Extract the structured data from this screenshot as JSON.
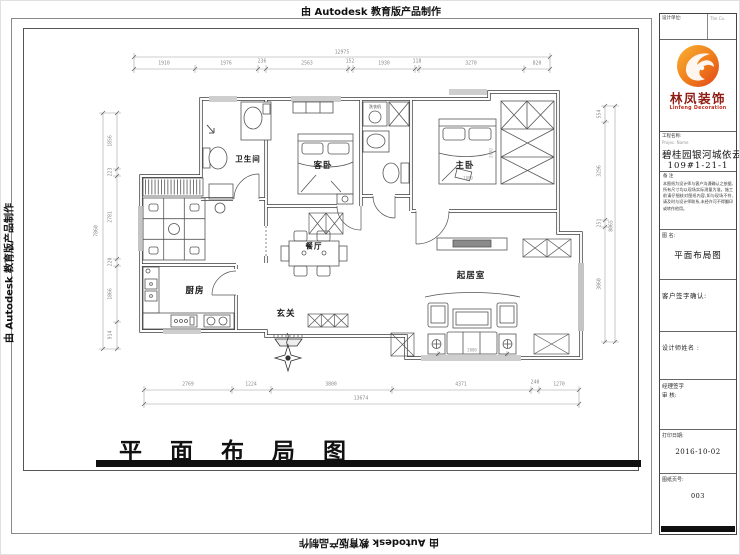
{
  "banner": {
    "autodesk": "由 Autodesk 教育版产品制作"
  },
  "drawing": {
    "title": "平 面 布 局 图"
  },
  "plan": {
    "rooms": {
      "bathroom": "卫生间",
      "guest_bedroom": "客卧",
      "master_bedroom": "主卧",
      "kitchen": "厨房",
      "dining": "餐厅",
      "entry": "玄关",
      "living": "起居室",
      "washing_machine": "洗衣机"
    },
    "dims": {
      "top": {
        "total": "12975",
        "segments": [
          "1910",
          "1976",
          "236",
          "2563",
          "152",
          "1930",
          "118",
          "3270",
          "820"
        ]
      },
      "bottom": {
        "total": "13674",
        "segments": [
          "2769",
          "1224",
          "3800",
          "4371",
          "240",
          "1270"
        ]
      },
      "left": {
        "total": "7860",
        "segments": [
          "1856",
          "223",
          "2781",
          "220",
          "1866",
          "914"
        ]
      },
      "right": {
        "total": "8065",
        "segments": [
          "554",
          "3296",
          "251",
          "3860"
        ]
      },
      "inner": {
        "sofa": "3800",
        "bed_w": "1800",
        "bed_l": "2000"
      }
    }
  },
  "titleblock": {
    "design_unit_label": "设计单位:",
    "design_unit_value": "The  Co.",
    "logo": {
      "cn": "林凤装饰",
      "en": "Linfeng Decoration",
      "accent": "#EF7B1A",
      "text": "#8E1C12"
    },
    "project_label": "工程名称:",
    "project_label_en": "Projec. Name",
    "project_name": "碧桂园银河城依云",
    "project_no": "109#1-21-1",
    "notes_label": "备  注",
    "notes_text": "本图纸为设计师与客户沟通确认之依据,所有尺寸均以现场实际测量为准。施工前请仔细核对图纸内容,如与现场不符,请及时与设计师联系,未经许可不得翻印或转作他用。",
    "drawing_name_label": "图  名:",
    "drawing_name": "平面布局图",
    "customer_sign_label": "客户签字确认:",
    "designer_sign_label": "设计师姓名 :",
    "manager_sign_label": "经理签字",
    "review_label": "审  核:",
    "print_date_label": "打印日期:",
    "print_date": "2016-10-02",
    "sheet_no_label": "图纸页号:",
    "sheet_no": "003"
  }
}
